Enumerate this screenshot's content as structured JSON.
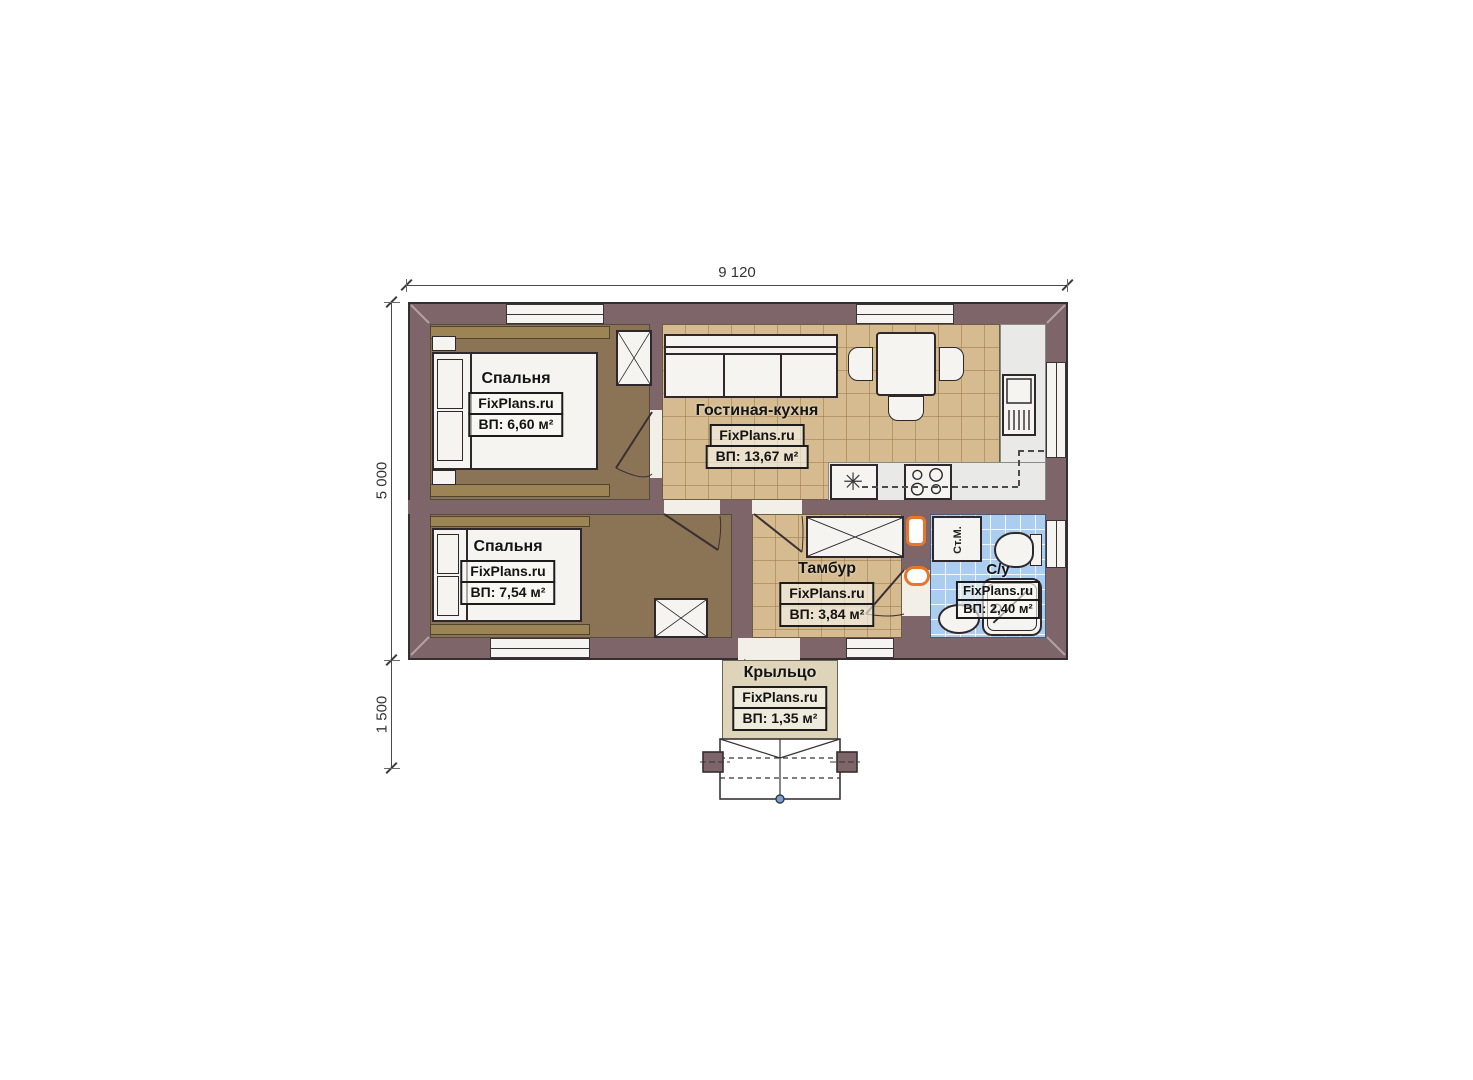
{
  "dimensions": {
    "width_label": "9 120",
    "height_label": "5 000",
    "porch_depth_label": "1 500"
  },
  "rooms": [
    {
      "name": "Спальня",
      "brand": "FixPlans.ru",
      "area": "ВП: 6,60 м²"
    },
    {
      "name": "Спальня",
      "brand": "FixPlans.ru",
      "area": "ВП: 7,54 м²"
    },
    {
      "name": "Гостиная-кухня",
      "brand": "FixPlans.ru",
      "area": "ВП: 13,67 м²"
    },
    {
      "name": "Тамбур",
      "brand": "FixPlans.ru",
      "area": "ВП: 3,84 м²"
    },
    {
      "name": "С/у",
      "brand": "FixPlans.ru",
      "area": "ВП: 2,40 м²"
    },
    {
      "name": "Крыльцо",
      "brand": "FixPlans.ru",
      "area": "ВП: 1,35 м²"
    }
  ],
  "appliances": {
    "washing_machine": "Ст.М.",
    "fridge_symbol": "✳"
  },
  "colors": {
    "wall": "#7d6569",
    "bedroom_floor": "#8b7355",
    "living_tile": "#d5bb8f",
    "bath_tile": "#abcdf0",
    "porch": "#ded4b9",
    "kitchen_floor": "#e9e9e7",
    "accent_orange": "#e8762a"
  }
}
